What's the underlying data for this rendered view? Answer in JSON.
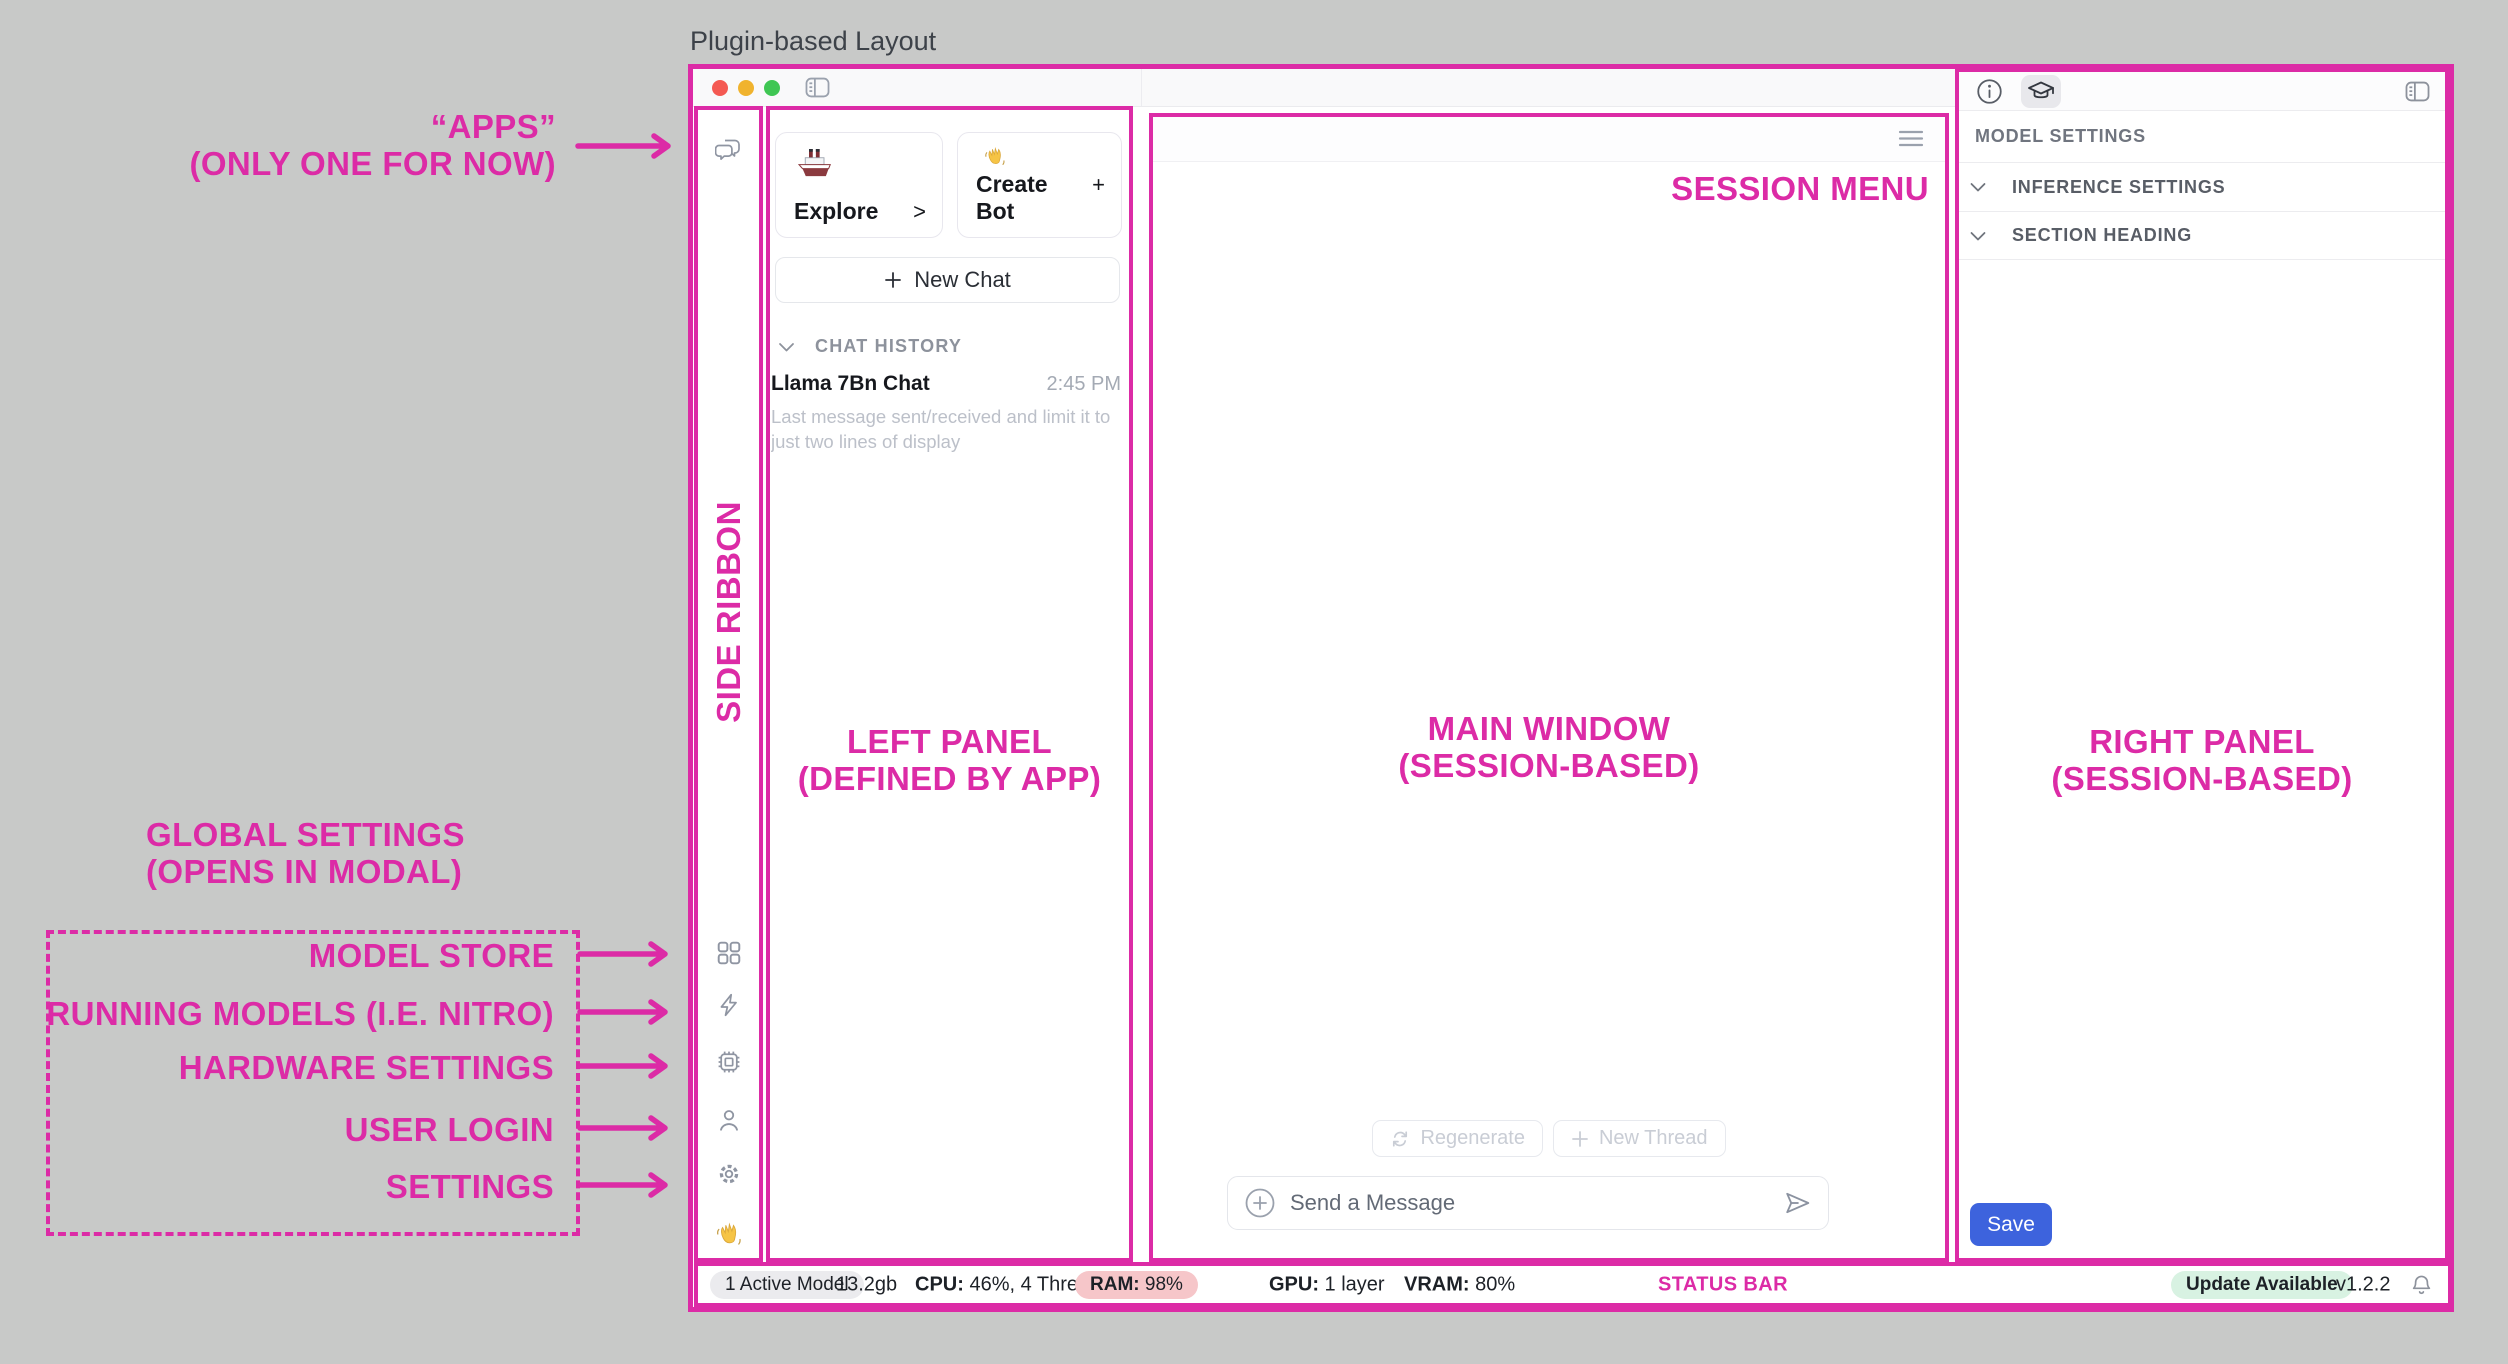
{
  "page": {
    "title": "Plugin-based Layout"
  },
  "annotations": {
    "pink": "#dc2ba6",
    "apps": {
      "line1": "“APPS”",
      "line2": "(ONLY ONE FOR NOW)"
    },
    "side_ribbon": "SIDE RIBBON",
    "left_panel": {
      "line1": "LEFT PANEL",
      "line2": "(DEFINED BY APP)"
    },
    "main_window": {
      "line1": "MAIN WINDOW",
      "line2": "(SESSION-BASED)"
    },
    "right_panel": {
      "line1": "RIGHT PANEL",
      "line2": "(SESSION-BASED)"
    },
    "session_menu": "SESSION MENU",
    "status_bar": "STATUS BAR",
    "global_settings": {
      "line1": "GLOBAL SETTINGS",
      "line2": "(OPENS IN MODAL)"
    },
    "ribbon_labels": [
      "MODEL STORE",
      "RUNNING MODELS (I.E. NITRO)",
      "HARDWARE SETTINGS",
      "USER LOGIN",
      "SETTINGS"
    ]
  },
  "left_panel": {
    "cards": [
      {
        "icon": "ship-icon",
        "label": "Explore",
        "affordance": ">"
      },
      {
        "icon": "wave-hand-icon",
        "label": "Create Bot",
        "affordance": "+"
      }
    ],
    "new_chat": "New Chat",
    "history_header": "CHAT HISTORY",
    "chats": [
      {
        "title": "Llama 7Bn Chat",
        "time": "2:45 PM",
        "preview": "Last message sent/received and limit it to just two lines of display"
      }
    ]
  },
  "main": {
    "regenerate": "Regenerate",
    "new_thread": "New Thread",
    "composer_placeholder": "Send a Message"
  },
  "right_panel": {
    "header": "MODEL SETTINGS",
    "sections": [
      "INFERENCE SETTINGS",
      "SECTION HEADING"
    ],
    "save": "Save"
  },
  "status_bar": {
    "active_model": "1 Active Model",
    "size": "13.2gb",
    "cpu_label": "CPU:",
    "cpu_value": " 46%, 4 Threads",
    "ram_label": "RAM:",
    "ram_value": " 98%",
    "gpu_label": "GPU:",
    "gpu_value": " 1 layer",
    "vram_label": "VRAM:",
    "vram_value": " 80%",
    "update": "Update Available",
    "version": "v1.2.2"
  },
  "icons": [
    "chat-bubbles",
    "grid",
    "bolt",
    "chip",
    "person",
    "gear",
    "wave-hand",
    "ship",
    "sidebar-toggle",
    "hamburger",
    "refresh",
    "plus",
    "plus-circle",
    "send",
    "chevron-down",
    "info",
    "graduation-cap",
    "bell"
  ]
}
